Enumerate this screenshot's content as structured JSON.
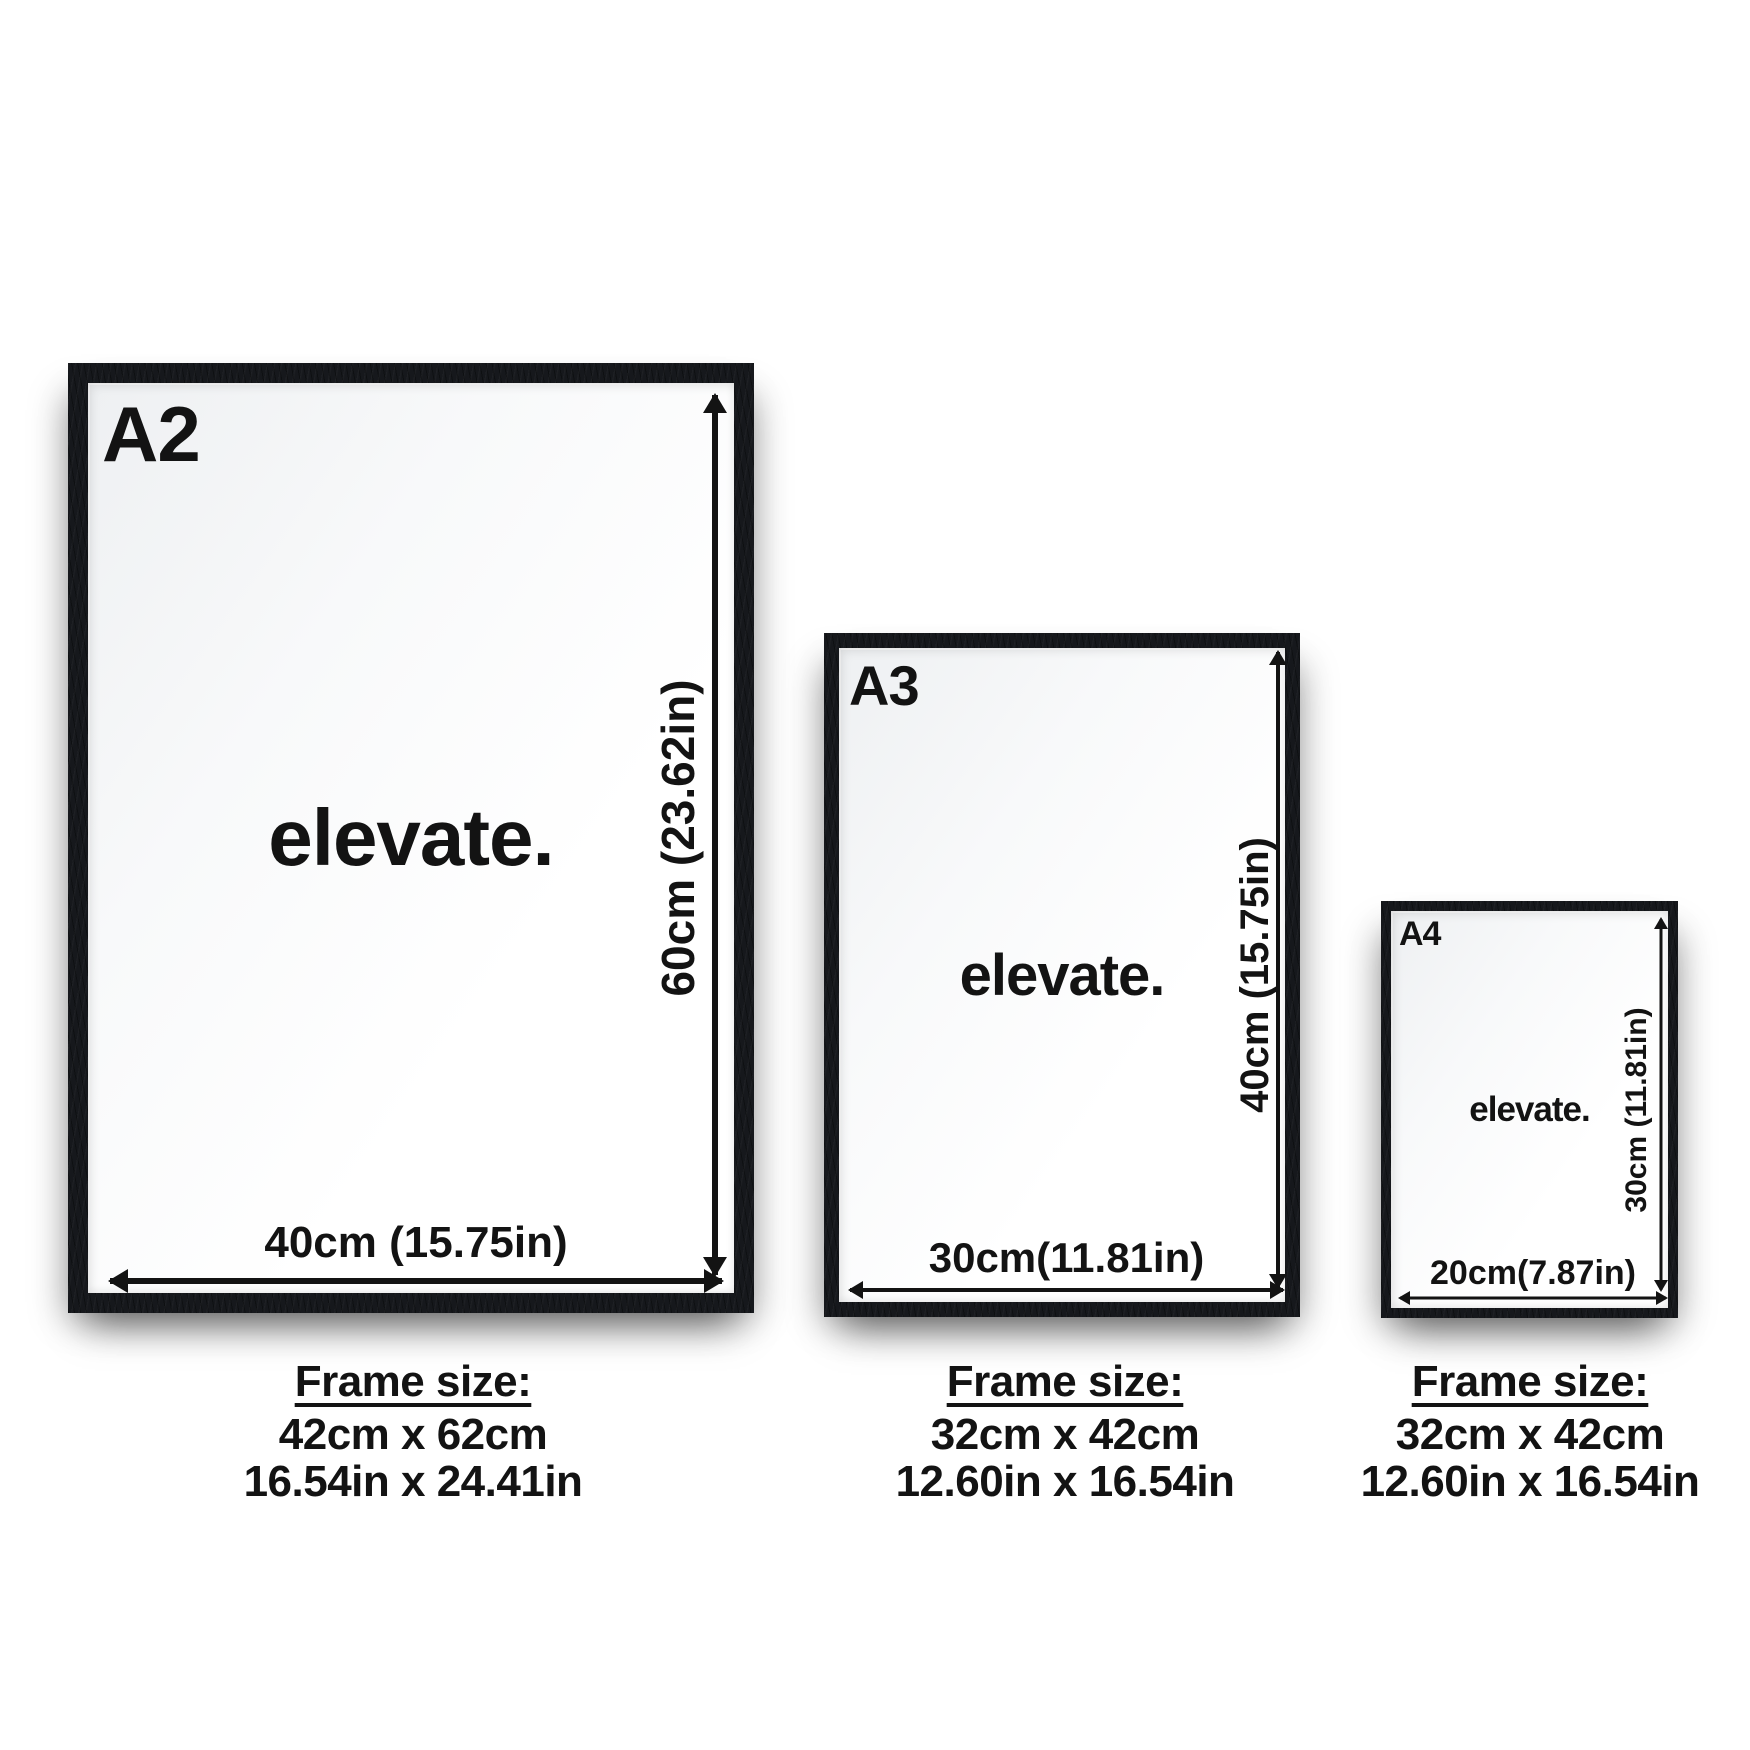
{
  "page": {
    "type": "poster-frame-size-guide"
  },
  "colors": {
    "frame": "#16181c",
    "text": "#131313",
    "background": "#ffffff"
  },
  "frames": [
    {
      "label": "A2",
      "poster_text": "elevate.",
      "vertical_dim": "60cm (23.62in)",
      "horizontal_dim": "40cm (15.75in)",
      "frame_size_heading": "Frame size:",
      "frame_size_cm": "42cm x 62cm",
      "frame_size_in": "16.54in x 24.41in"
    },
    {
      "label": "A3",
      "poster_text": "elevate.",
      "vertical_dim": "40cm (15.75in)",
      "horizontal_dim": "30cm(11.81in)",
      "frame_size_heading": "Frame size:",
      "frame_size_cm": "32cm x 42cm",
      "frame_size_in": "12.60in x 16.54in"
    },
    {
      "label": "A4",
      "poster_text": "elevate.",
      "vertical_dim": "30cm (11.81in)",
      "horizontal_dim": "20cm(7.87in)",
      "frame_size_heading": "Frame size:",
      "frame_size_cm": "32cm x 42cm",
      "frame_size_in": "12.60in x 16.54in"
    }
  ]
}
